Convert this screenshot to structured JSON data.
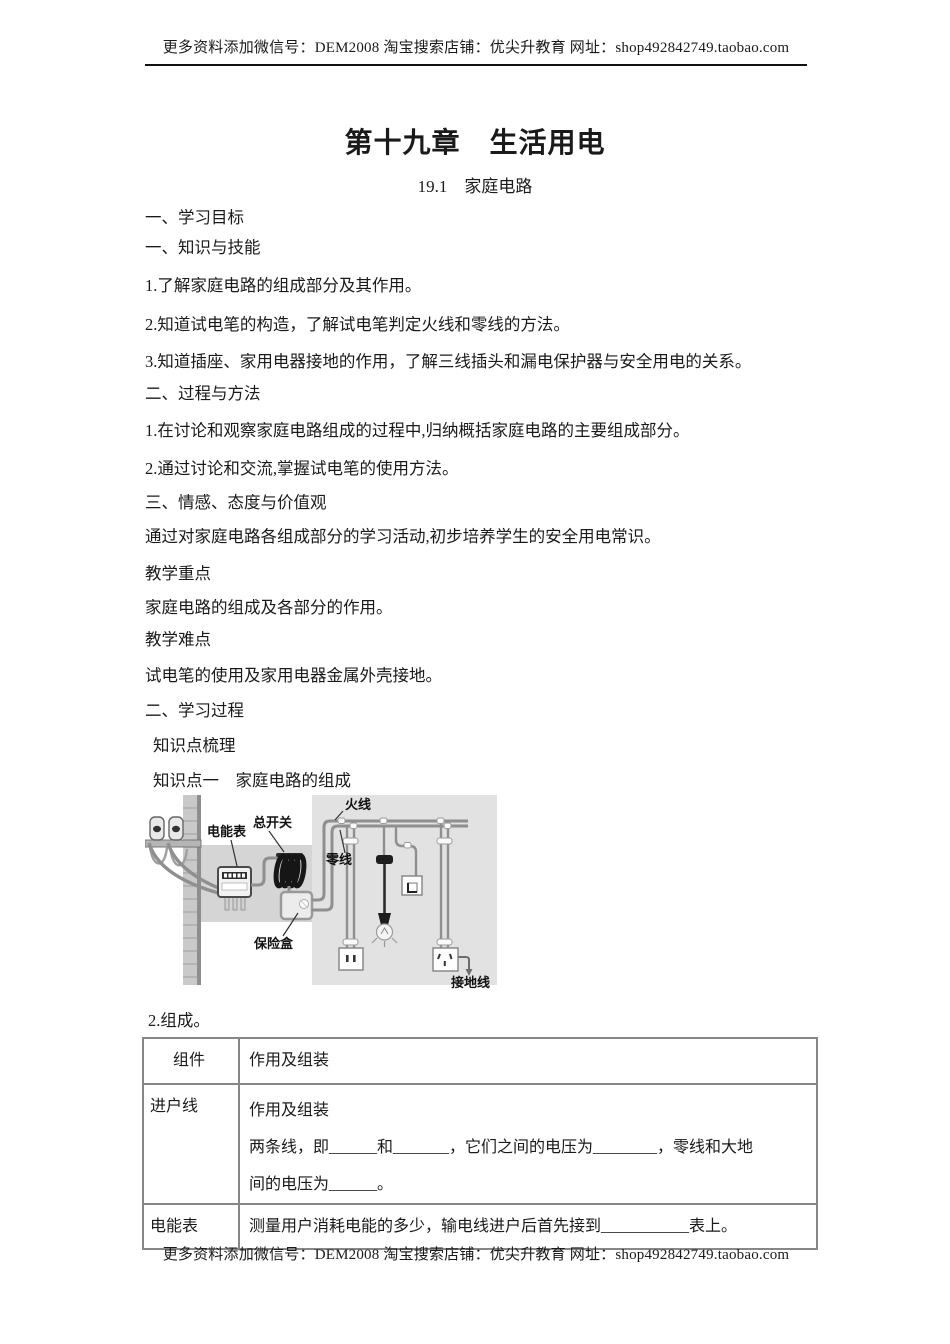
{
  "header": {
    "text": "更多资料添加微信号：DEM2008 淘宝搜索店铺：优尖升教育 网址：shop492842749.taobao.com"
  },
  "footer": {
    "text": "更多资料添加微信号：DEM2008 淘宝搜索店铺：优尖升教育 网址：shop492842749.taobao.com"
  },
  "title": "第十九章　生活用电",
  "subtitle": "19.1　家庭电路",
  "paragraphs": [
    "一、学习目标",
    "一、知识与技能",
    "1.了解家庭电路的组成部分及其作用。",
    "2.知道试电笔的构造，了解试电笔判定火线和零线的方法。",
    "3.知道插座、家用电器接地的作用，了解三线插头和漏电保护器与安全用电的关系。",
    "二、过程与方法",
    "1.在讨论和观察家庭电路组成的过程中,归纳概括家庭电路的主要组成部分。",
    "2.通过讨论和交流,掌握试电笔的使用方法。",
    "三、情感、态度与价值观",
    "通过对家庭电路各组成部分的学习活动,初步培养学生的安全用电常识。",
    "教学重点",
    "家庭电路的组成及各部分的作用。",
    "教学难点",
    "试电笔的使用及家用电器金属外壳接地。",
    "二、学习过程",
    "知识点梳理",
    "知识点一　家庭电路的组成"
  ],
  "item2": "2.组成。",
  "diagram": {
    "labels": {
      "meter": "电能表",
      "main_switch": "总开关",
      "fuse_box": "保险盒",
      "live_wire": "火线",
      "neutral_wire": "零线",
      "ground_wire": "接地线"
    }
  },
  "table": {
    "header": {
      "col1": "组件",
      "col2": "作用及组装"
    },
    "rows": [
      {
        "component": "进户线",
        "lines": [
          "作用及组装",
          "两条线，即______和_______，它们之间的电压为________，零线和大地",
          "间的电压为______。"
        ]
      },
      {
        "component": "电能表",
        "lines": [
          "测量用户消耗电能的多少，输电线进户后首先接到___________表上。"
        ]
      }
    ]
  }
}
